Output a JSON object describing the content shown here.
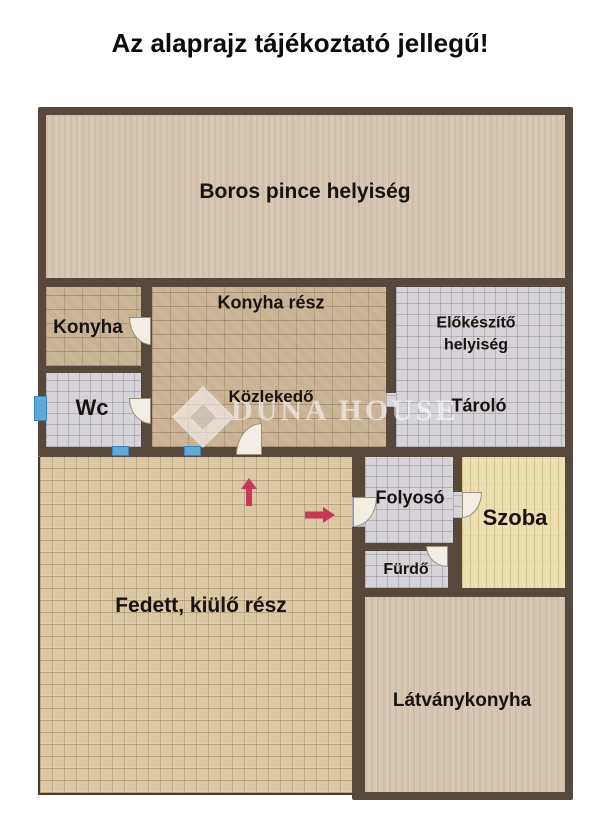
{
  "title": "Az alaprajz tájékoztató jellegű!",
  "watermark": {
    "text": "DUNA HOUSE",
    "logo": "duna-house-diamond-icon"
  },
  "rooms": {
    "boros_pince": {
      "label": "Boros pince helyiség"
    },
    "konyha": {
      "label": "Konyha"
    },
    "konyha_resz": {
      "label": "Konyha rész"
    },
    "wc": {
      "label": "Wc"
    },
    "kozlekedo": {
      "label": "Közlekedő"
    },
    "elokeszito": {
      "label": "Előkészítő helyiség"
    },
    "tarolo": {
      "label": "Tároló"
    },
    "fedett": {
      "label": "Fedett, kiülő rész"
    },
    "folyoso": {
      "label": "Folyosó"
    },
    "szoba": {
      "label": "Szoba"
    },
    "furdo": {
      "label": "Fürdő"
    },
    "latvanykonyha": {
      "label": "Látványkonyha"
    }
  },
  "annotations": {
    "arrows": [
      "up",
      "right"
    ],
    "window_count": 3,
    "door_count": 6
  },
  "colors": {
    "wall": "#56493c",
    "wood_floor": "#d7c6b2",
    "brick_floor": "#c9b193",
    "tile_floor": "#d6d4d8",
    "stripe_floor": "#ecdfb2",
    "terrace_floor": "#dcc7a5",
    "window_blue": "#5fa9d8",
    "arrow_red": "#c63a58",
    "door_fill": "#f2eee4",
    "title_text": "#0c0c0c"
  }
}
